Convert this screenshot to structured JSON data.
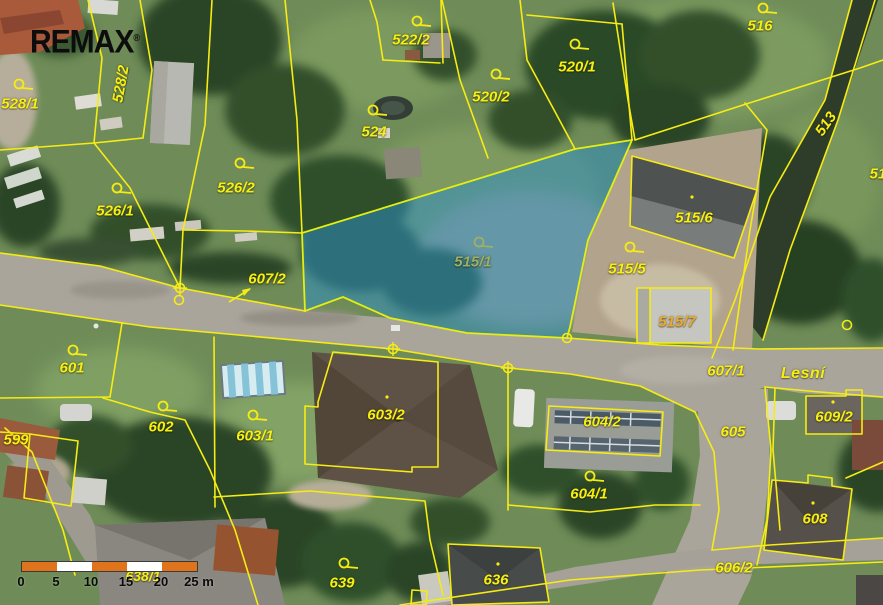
{
  "meta": {
    "width": 883,
    "height": 605,
    "view": "cadastral-aerial-map"
  },
  "branding": {
    "logo": "REMAX",
    "mark": "®"
  },
  "map": {
    "highlighted_parcel": "515/1",
    "colors": {
      "boundary": "#f6ec14",
      "highlight_fill": "#2d8ec6",
      "highlight_opacity": 0.52,
      "label_default": "#f8ef12",
      "label_on_highlight": "#9cb066",
      "label_gold": "#e9a930",
      "scale_orange": "#e0741c",
      "scale_white": "#ffffff"
    },
    "street_labels": [
      {
        "text": "Lesní",
        "x": 803,
        "y": 374
      }
    ],
    "parcel_labels": [
      {
        "text": "528/1",
        "x": 20,
        "y": 104,
        "flag": {
          "x": 19,
          "y": 84
        }
      },
      {
        "text": "528/2",
        "x": 121,
        "y": 84,
        "rot": -80
      },
      {
        "text": "526/1",
        "x": 115,
        "y": 211,
        "flag": {
          "x": 117,
          "y": 188
        }
      },
      {
        "text": "526/2",
        "x": 236,
        "y": 188,
        "flag": {
          "x": 240,
          "y": 163
        }
      },
      {
        "text": "522/2",
        "x": 411,
        "y": 40,
        "flag": {
          "x": 417,
          "y": 21
        }
      },
      {
        "text": "524",
        "x": 374,
        "y": 132,
        "flag": {
          "x": 373,
          "y": 110
        }
      },
      {
        "text": "520/2",
        "x": 491,
        "y": 97,
        "flag": {
          "x": 496,
          "y": 74
        }
      },
      {
        "text": "520/1",
        "x": 577,
        "y": 67,
        "flag": {
          "x": 575,
          "y": 44
        }
      },
      {
        "text": "516",
        "x": 760,
        "y": 26,
        "flag": {
          "x": 763,
          "y": 8
        }
      },
      {
        "text": "513",
        "x": 826,
        "y": 124,
        "rot": -55
      },
      {
        "text": "51",
        "x": 878,
        "y": 174
      },
      {
        "text": "607/2",
        "x": 267,
        "y": 279
      },
      {
        "text": "515/1",
        "x": 473,
        "y": 262,
        "color": "#9cb066",
        "flag": {
          "x": 479,
          "y": 242,
          "color": "#9cb066"
        }
      },
      {
        "text": "515/5",
        "x": 627,
        "y": 269,
        "flag": {
          "x": 630,
          "y": 247
        }
      },
      {
        "text": "515/6",
        "x": 694,
        "y": 218
      },
      {
        "text": "515/7",
        "x": 677,
        "y": 322,
        "color": "#e9a930"
      },
      {
        "text": "601",
        "x": 72,
        "y": 368,
        "flag": {
          "x": 73,
          "y": 350
        }
      },
      {
        "text": "602",
        "x": 161,
        "y": 427,
        "flag": {
          "x": 163,
          "y": 406
        }
      },
      {
        "text": "603/1",
        "x": 255,
        "y": 436,
        "flag": {
          "x": 253,
          "y": 415
        }
      },
      {
        "text": "603/2",
        "x": 386,
        "y": 415
      },
      {
        "text": "604/2",
        "x": 602,
        "y": 422
      },
      {
        "text": "604/1",
        "x": 589,
        "y": 494,
        "flag": {
          "x": 590,
          "y": 476
        }
      },
      {
        "text": "605",
        "x": 733,
        "y": 432
      },
      {
        "text": "607/1",
        "x": 726,
        "y": 371
      },
      {
        "text": "609/2",
        "x": 834,
        "y": 417
      },
      {
        "text": "608",
        "x": 815,
        "y": 519
      },
      {
        "text": "606/2",
        "x": 734,
        "y": 568
      },
      {
        "text": "639",
        "x": 342,
        "y": 583,
        "flag": {
          "x": 344,
          "y": 563
        }
      },
      {
        "text": "636",
        "x": 496,
        "y": 580
      },
      {
        "text": "599",
        "x": 16,
        "y": 440
      },
      {
        "text": "638/1",
        "x": 143,
        "y": 576,
        "cls": "under",
        "size": 14
      }
    ],
    "survey_points": [
      {
        "kind": "circle-cross",
        "x": 180,
        "y": 288
      },
      {
        "kind": "circle",
        "x": 179,
        "y": 300
      },
      {
        "kind": "circle-cross",
        "x": 393,
        "y": 349
      },
      {
        "kind": "circle-cross",
        "x": 508,
        "y": 368
      },
      {
        "kind": "circle",
        "x": 567,
        "y": 338
      },
      {
        "kind": "circle",
        "x": 847,
        "y": 325
      }
    ],
    "building_dots": [
      {
        "x": 692,
        "y": 197
      },
      {
        "x": 387,
        "y": 397
      },
      {
        "x": 498,
        "y": 564
      },
      {
        "x": 833,
        "y": 402
      },
      {
        "x": 813,
        "y": 503
      }
    ],
    "annotation_arrow": {
      "x1": 229,
      "y1": 302,
      "x2": 250,
      "y2": 289,
      "head": "251,288 244,296 242,290"
    }
  },
  "scale_bar": {
    "x": 21,
    "y": 561,
    "segments": [
      "#e0741c",
      "#ffffff",
      "#e0741c",
      "#ffffff",
      "#e0741c"
    ],
    "ticks": [
      {
        "label": "0",
        "x": 0
      },
      {
        "label": "5",
        "x": 35
      },
      {
        "label": "10",
        "x": 70
      },
      {
        "label": "15",
        "x": 105
      },
      {
        "label": "20",
        "x": 140
      },
      {
        "label": "25 m",
        "x": 178
      }
    ]
  }
}
